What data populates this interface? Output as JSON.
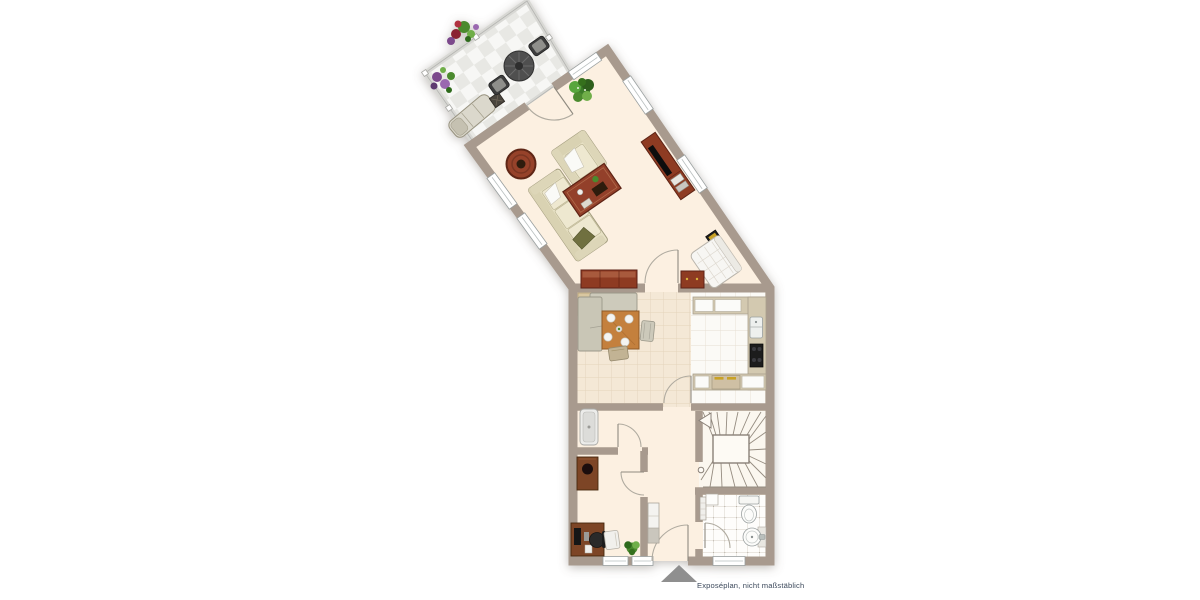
{
  "caption": {
    "text": "Exposéplan, nicht maßstäblich"
  },
  "palette": {
    "wall": "#a89a8e",
    "floor_cream": "#fcf0e1",
    "tile_beige": "#f4e8d6",
    "tile_beige_grid": "#e3d3bb",
    "tile_white": "#fbfaf6",
    "tile_white_grid": "#e6dfd3",
    "bath_grid": "#c9c1b5",
    "terrace_tile": "#e8e8e4",
    "wood_red": "#8e3a22",
    "wood_red_dark": "#5d2413",
    "wood_oak": "#c4803e",
    "wood_desk": "#7d4527",
    "sofa": "#e7e1c4",
    "sofa_outline": "#a29c7e",
    "plant_green": "#4c8a2f",
    "fixture_outline": "#9aa0a0",
    "stair_line": "#958c80",
    "entrance_arrow": "#8f8f8f",
    "caption_color": "#3d4a5c"
  },
  "areas": {
    "names": [
      "terrace",
      "living-room",
      "dining-area",
      "kitchen",
      "hallway",
      "wc",
      "office",
      "stairwell",
      "bathroom"
    ]
  },
  "furniture": [
    "terrace-table",
    "terrace-chair",
    "sun-lounger",
    "planter",
    "flower-bed",
    "sofa",
    "armchair",
    "coffee-table",
    "round-rug",
    "potted-plant",
    "tv-sideboard",
    "sideboard",
    "lowboard",
    "wall-picture",
    "lounge-chair",
    "corner-bench",
    "dining-table",
    "dining-chair",
    "kitchen-counter",
    "kitchen-sink",
    "cooktop",
    "oven",
    "shower",
    "hall-cabinet",
    "wardrobe",
    "desk",
    "office-chair",
    "visitor-chair",
    "toilet",
    "washbasin",
    "radiator",
    "winder-stairs",
    "entrance-arrow"
  ]
}
